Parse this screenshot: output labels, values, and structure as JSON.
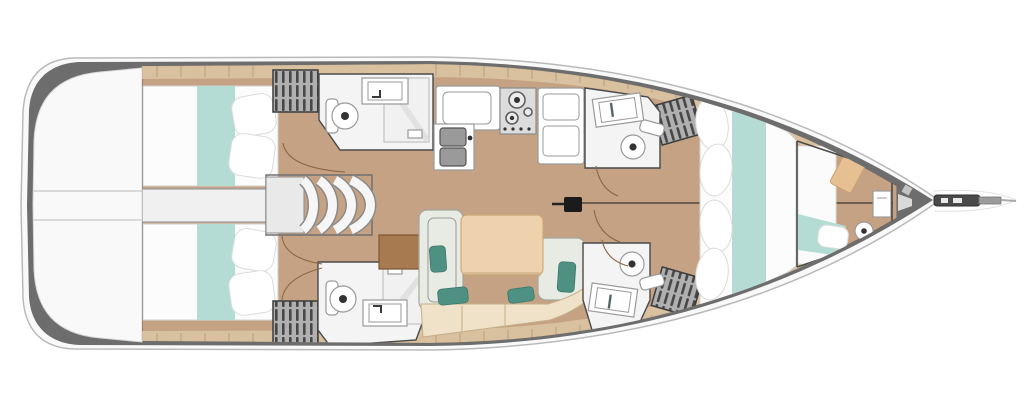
{
  "meta": {
    "type": "floor-plan",
    "subject": "sailing-yacht-interior-top-view",
    "orientation": "bow-right",
    "canvas": "1024x411"
  },
  "colors": {
    "hull_edge": "#b9b9b9",
    "hull_fill": "#f9f9f9",
    "deck_dark": "#6d6d6d",
    "wood": "#c5a283",
    "wood_light": "#dcc5a4",
    "room_floor": "#f4f4f4",
    "wall": "#4a4a4a",
    "bedding": "#fcfcfc",
    "bed_teal": "#b5dcd4",
    "cushion_teal": "#4e9183",
    "sofa": "#e8ebe3",
    "bench": "#f0e2c8",
    "table": "#edd2ad",
    "desk": "#a87a50",
    "locker_bg": "#b0b0b0",
    "locker_slat": "#474747",
    "fixture_white": "#ffffff",
    "fixture_line": "#9a9a9a",
    "mast": "#1b1b1b",
    "door_arc": "#8a6844"
  },
  "rooms": {
    "swim_platform": "swim-platform",
    "engine_room": "engine-compartment",
    "aft_cabin_port": "aft-cabin-port",
    "aft_cabin_starboard": "aft-cabin-starboard",
    "aft_head_port": "aft-head-port",
    "aft_head_starboard": "aft-head-starboard",
    "companionway": "companionway-steps",
    "galley": "galley",
    "chart_table": "chart-table",
    "salon": "salon",
    "forward_head_port": "forward-head-port",
    "forward_head_starboard": "forward-head-starboard",
    "forward_cabin": "forward-cabin",
    "bow_cabin": "bow-crew-cabin",
    "anchor_locker": "anchor-locker",
    "mast": "mast-base",
    "bowsprit": "bowsprit"
  }
}
